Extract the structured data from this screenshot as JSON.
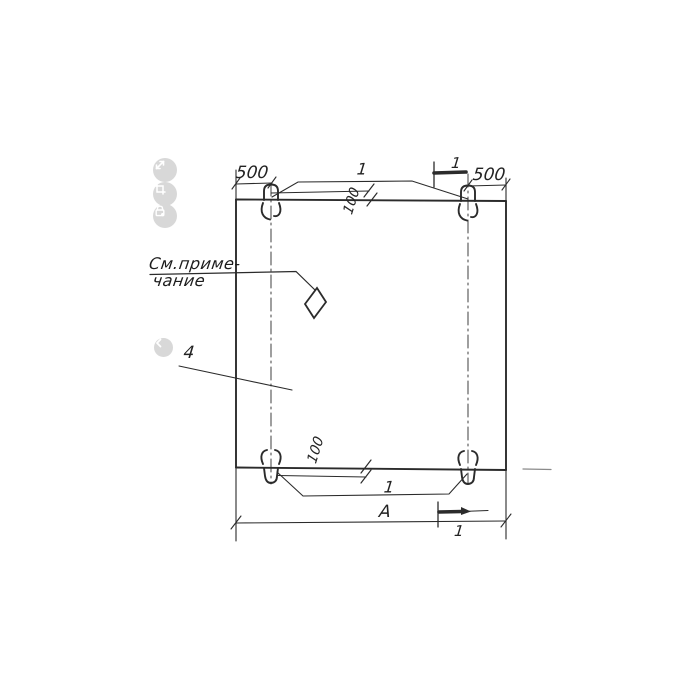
{
  "drawing": {
    "note": {
      "line1": "См.приме-",
      "line2": "чание"
    },
    "labels": {
      "dim_left_500": "500",
      "dim_right_500": "500",
      "loop_callout_top": "1",
      "loop_callout_bottom": "1",
      "offset_top_100": "100",
      "offset_bottom_100": "100",
      "section_mark_top": "1",
      "section_mark_bottom": "1",
      "width_dim": "А",
      "part_number": "4"
    }
  },
  "overlay": {
    "buttons": [
      {
        "icon": "expand-icon"
      },
      {
        "icon": "crop-icon"
      },
      {
        "icon": "lock-icon"
      }
    ],
    "nav": {
      "icon": "chevron-left-icon"
    }
  },
  "colors": {
    "ink": "#2b2b2b",
    "overlay_button_bg": "#d8d8d8",
    "overlay_glyph": "#ffffff"
  }
}
